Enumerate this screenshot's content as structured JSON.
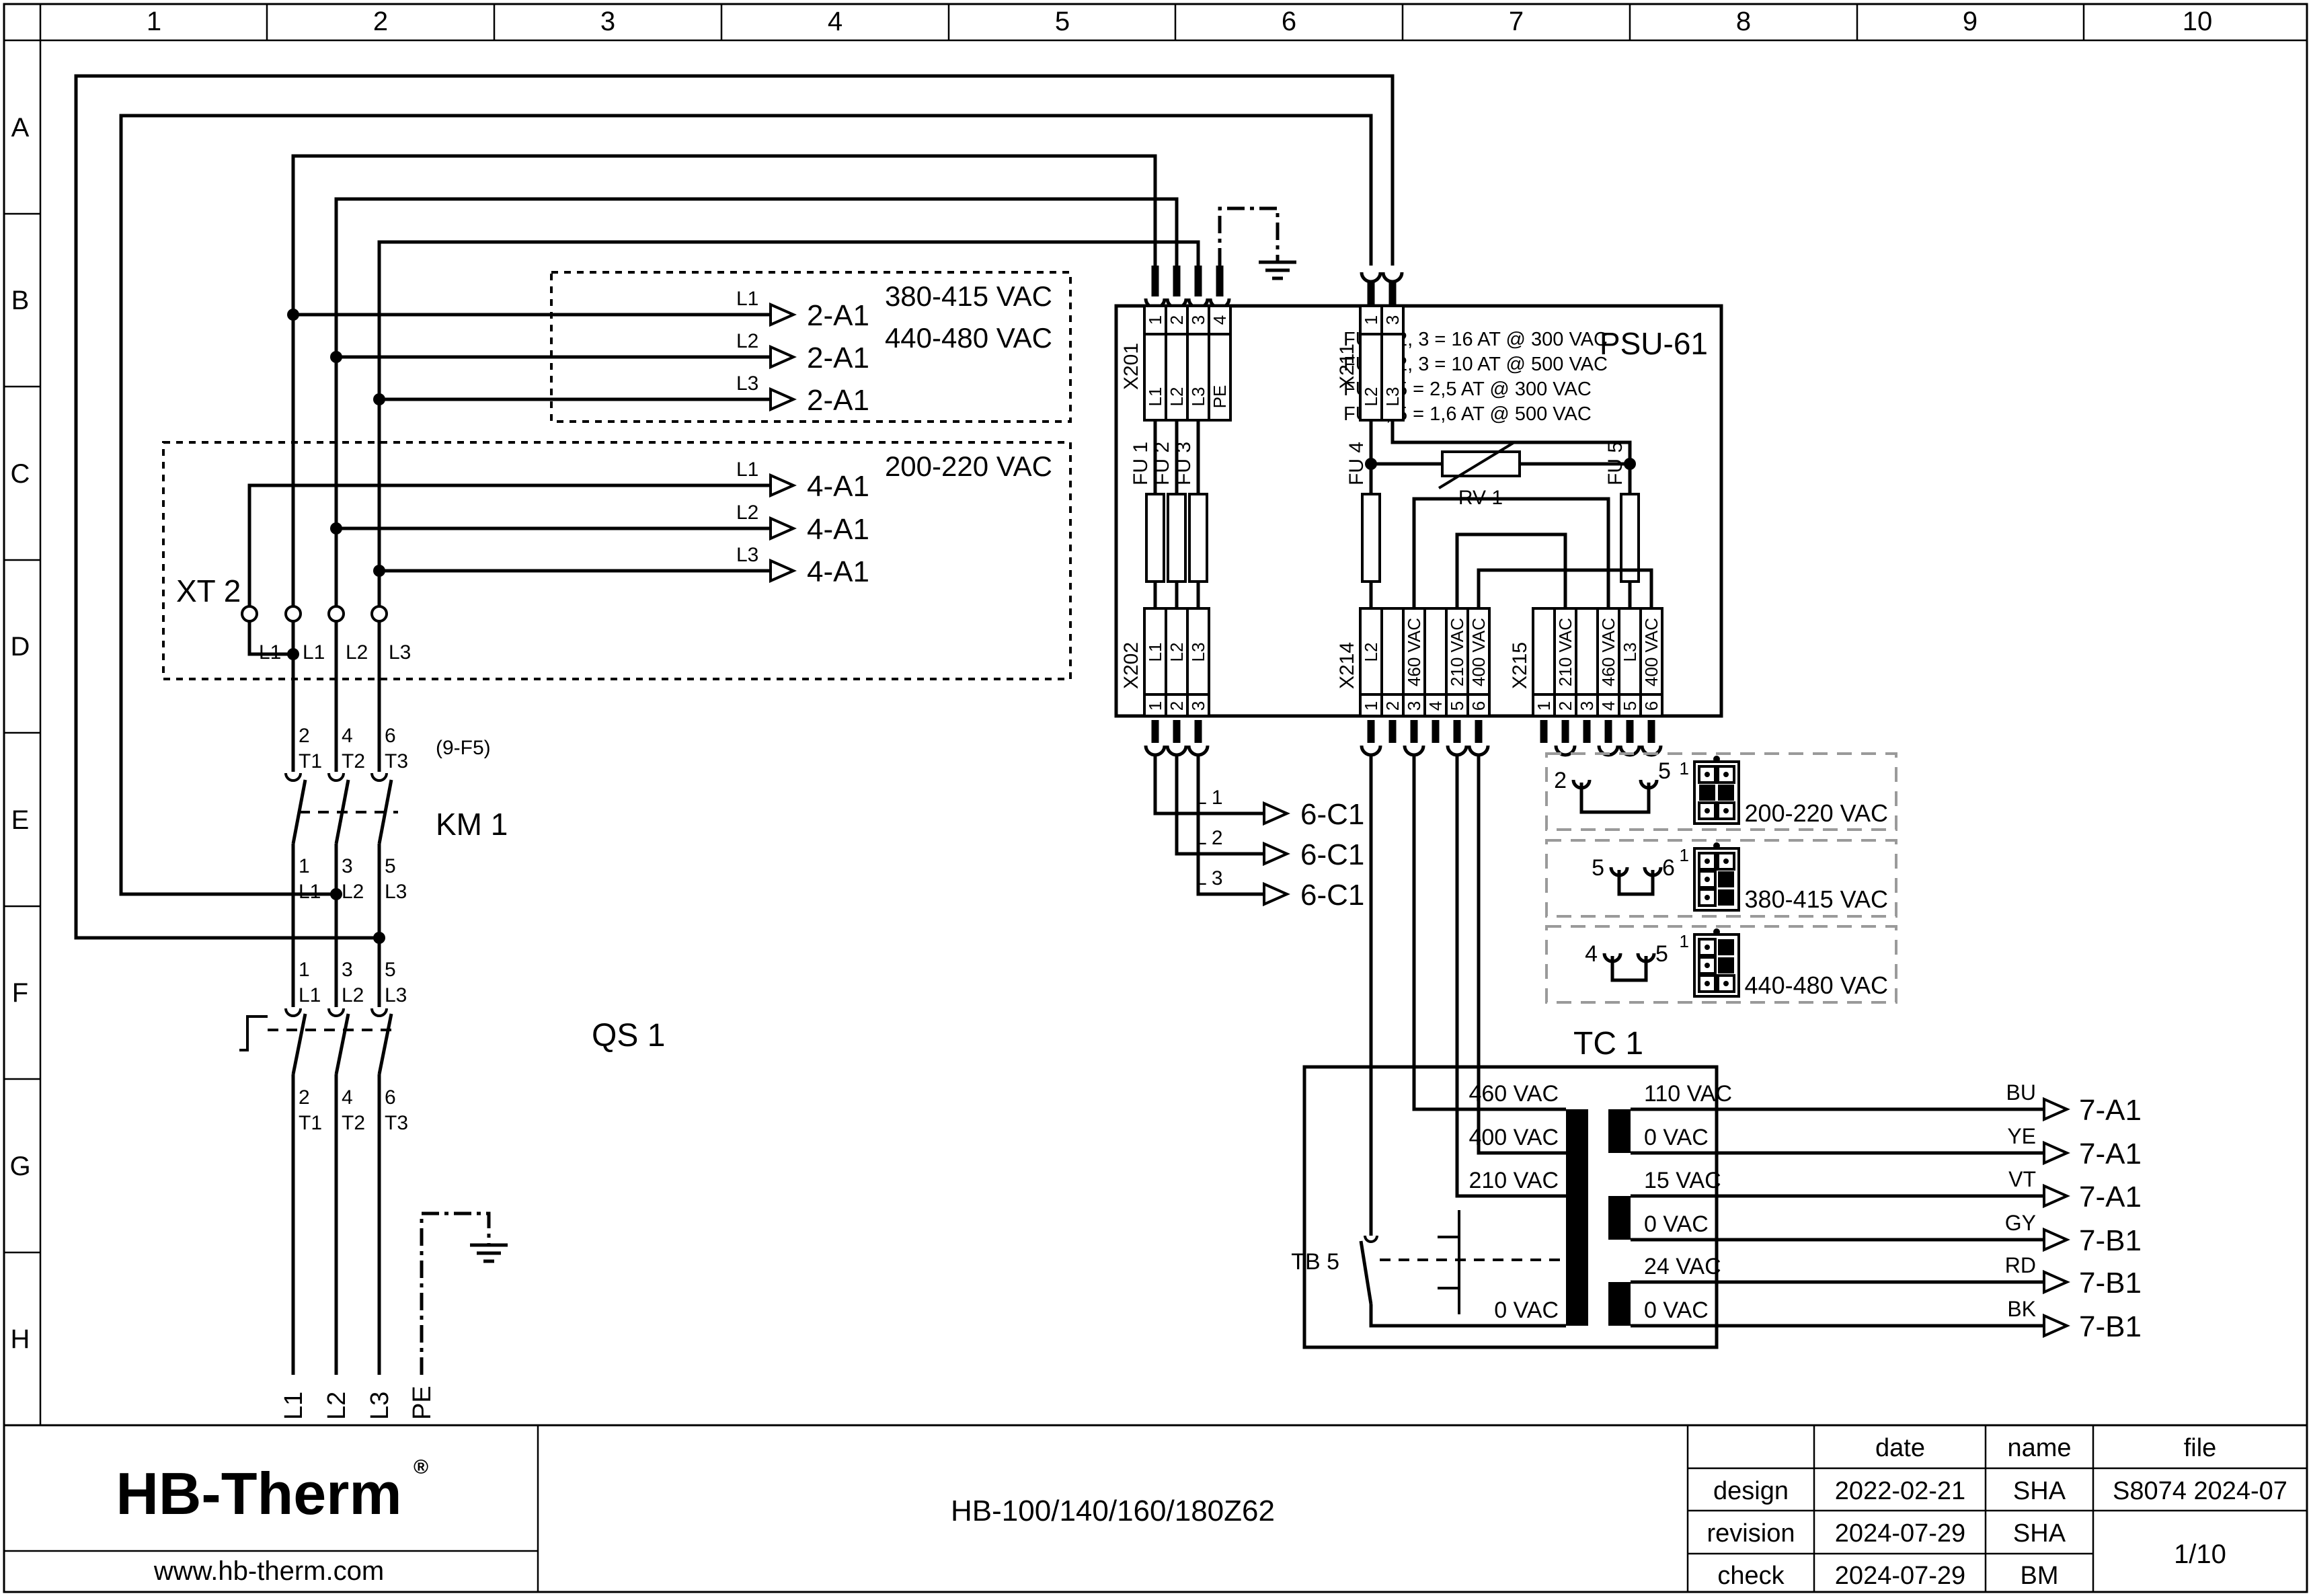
{
  "ruler": {
    "cols": [
      "1",
      "2",
      "3",
      "4",
      "5",
      "6",
      "7",
      "8",
      "9",
      "10"
    ],
    "rows": [
      "A",
      "B",
      "C",
      "D",
      "E",
      "F",
      "G",
      "H"
    ]
  },
  "vac_boxes": {
    "high": {
      "lines": [
        "380-415 VAC",
        "440-480 VAC"
      ],
      "rows": [
        {
          "phase": "L1",
          "target": "2-A1"
        },
        {
          "phase": "L2",
          "target": "2-A1"
        },
        {
          "phase": "L3",
          "target": "2-A1"
        }
      ]
    },
    "low": {
      "line": "200-220 VAC",
      "rows": [
        {
          "phase": "L1",
          "target": "4-A1"
        },
        {
          "phase": "L2",
          "target": "4-A1"
        },
        {
          "phase": "L3",
          "target": "4-A1"
        }
      ]
    }
  },
  "xt2": {
    "label": "XT 2",
    "pins": [
      "L1",
      "L1",
      "L2",
      "L3"
    ]
  },
  "km1": {
    "label": "KM 1",
    "ref": "(9-F5)",
    "top": [
      {
        "n": "2",
        "t": "T1"
      },
      {
        "n": "4",
        "t": "T2"
      },
      {
        "n": "6",
        "t": "T3"
      }
    ],
    "bottom": [
      {
        "n": "1",
        "t": "L1"
      },
      {
        "n": "3",
        "t": "L2"
      },
      {
        "n": "5",
        "t": "L3"
      }
    ]
  },
  "qs1": {
    "label": "QS 1",
    "top": [
      {
        "n": "1",
        "t": "L1"
      },
      {
        "n": "3",
        "t": "L2"
      },
      {
        "n": "5",
        "t": "L3"
      }
    ],
    "bottom": [
      {
        "n": "2",
        "t": "T1"
      },
      {
        "n": "4",
        "t": "T2"
      },
      {
        "n": "6",
        "t": "T3"
      }
    ]
  },
  "mains": [
    "L1",
    "L2",
    "L3",
    "PE"
  ],
  "psu": {
    "label": "PSU-61",
    "notes": [
      "FU 1, 2, 3 = 16 AT @ 300 VAC",
      "FU 1, 2, 3 = 10 AT @ 500 VAC",
      "FU 4, 5 = 2,5 AT @ 300 VAC",
      "FU 4, 5 = 1,6 AT @ 500 VAC"
    ],
    "x201": {
      "label": "X201",
      "nums": [
        "1",
        "2",
        "3",
        "4"
      ],
      "names": [
        "L1",
        "L2",
        "L3",
        "PE"
      ]
    },
    "x211": {
      "label": "X211",
      "nums": [
        "1",
        "3"
      ],
      "names": [
        "L2",
        "L3"
      ]
    },
    "x202": {
      "label": "X202",
      "nums": [
        "1",
        "2",
        "3"
      ],
      "names": [
        "L1",
        "L2",
        "L3"
      ]
    },
    "x214": {
      "label": "X214",
      "nums": [
        "1",
        "2",
        "3",
        "4",
        "5",
        "6"
      ],
      "names": [
        "L2",
        "",
        "460 VAC",
        "",
        "210 VAC",
        "400 VAC"
      ]
    },
    "x215": {
      "label": "X215",
      "nums": [
        "1",
        "2",
        "3",
        "4",
        "5",
        "6"
      ],
      "names": [
        "",
        "210 VAC",
        "",
        "460 VAC",
        "L3",
        "400 VAC"
      ]
    },
    "fu": [
      "FU 1",
      "FU 2",
      "FU 3",
      "FU 4",
      "FU 5"
    ],
    "rv": "RV 1"
  },
  "c1_rows": [
    {
      "phase": "L 1",
      "target": "6-C1"
    },
    {
      "phase": "L 2",
      "target": "6-C1"
    },
    {
      "phase": "L 3",
      "target": "6-C1"
    }
  ],
  "jumpers": [
    {
      "a": "2",
      "b": "5",
      "pin1": "1",
      "label": "200-220 VAC"
    },
    {
      "a": "5",
      "b": "6",
      "pin1": "1",
      "label": "380-415 VAC"
    },
    {
      "a": "4",
      "b": "5",
      "pin1": "1",
      "label": "440-480 VAC"
    }
  ],
  "tc1": {
    "label": "TC 1",
    "tb": "TB 5",
    "primary": [
      "460 VAC",
      "400 VAC",
      "210 VAC",
      "0 VAC"
    ],
    "secondary": [
      "110 VAC",
      "0 VAC",
      "15 VAC",
      "0 VAC",
      "24 VAC",
      "0 VAC"
    ],
    "outputs": [
      {
        "color": "BU",
        "target": "7-A1"
      },
      {
        "color": "YE",
        "target": "7-A1"
      },
      {
        "color": "VT",
        "target": "7-A1"
      },
      {
        "color": "GY",
        "target": "7-B1"
      },
      {
        "color": "RD",
        "target": "7-B1"
      },
      {
        "color": "BK",
        "target": "7-B1"
      }
    ]
  },
  "titleblock": {
    "logo": "HB-Therm",
    "reg": "®",
    "website": "www.hb-therm.com",
    "title": "HB-100/140/160/180Z62",
    "col_date": "date",
    "col_name": "name",
    "col_file": "file",
    "rows": [
      {
        "label": "design",
        "date": "2022-02-21",
        "name": "SHA"
      },
      {
        "label": "revision",
        "date": "2024-07-29",
        "name": "SHA"
      },
      {
        "label": "check",
        "date": "2024-07-29",
        "name": "BM"
      }
    ],
    "file_no": "S8074 2024-07",
    "page": "1/10"
  },
  "colors": {
    "logo_navy": "#1c2747",
    "line": "#000000",
    "jumper_gray": "#9a9a9a"
  }
}
